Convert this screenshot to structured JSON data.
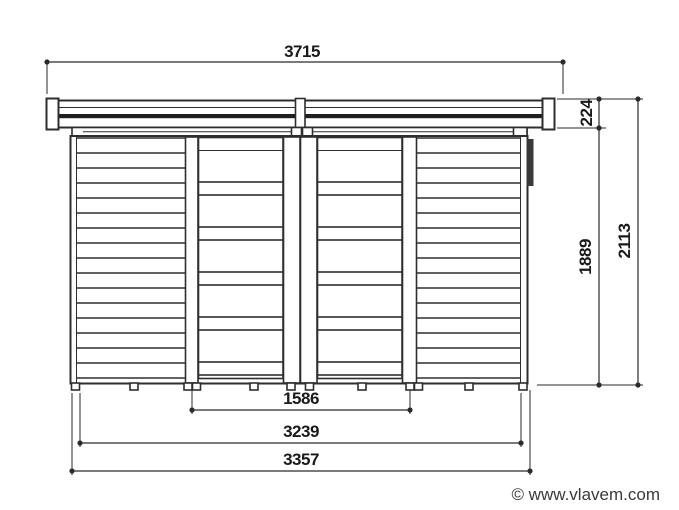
{
  "drawing": {
    "title": "shed-front-elevation",
    "dims": {
      "roof_width": "3715",
      "roof_height": "224",
      "wall_height": "1889",
      "total_height": "2113",
      "door_width": "1586",
      "base_inner_width": "3239",
      "base_outer_width": "3357"
    },
    "colors": {
      "line": "#2e2e2e",
      "background": "#ffffff",
      "corner_shadow": "#3a3a3a"
    }
  },
  "footer": {
    "copyright": "© www.vlavem.com"
  }
}
